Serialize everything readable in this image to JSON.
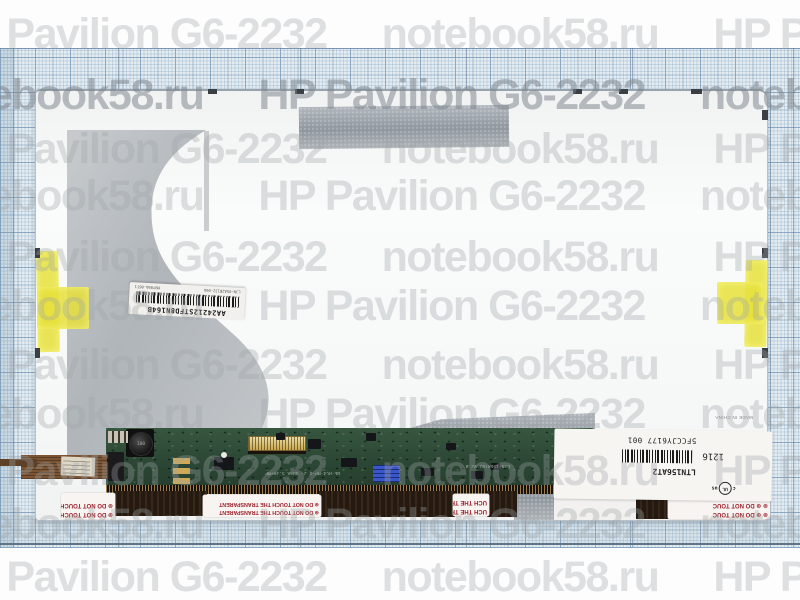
{
  "watermark": {
    "model_text": "HP Pavilion G6-2232",
    "site_text": "notebook58.ru",
    "rows": [
      {
        "y": 35,
        "offset": -60,
        "strong": false
      },
      {
        "y": 96,
        "offset": -515,
        "strong": true
      },
      {
        "y": 150,
        "offset": -60,
        "strong": false
      },
      {
        "y": 197,
        "offset": -515,
        "strong": false
      },
      {
        "y": 258,
        "offset": -60,
        "strong": false
      },
      {
        "y": 307,
        "offset": -515,
        "strong": false
      },
      {
        "y": 366,
        "offset": -60,
        "strong": false
      },
      {
        "y": 415,
        "offset": -515,
        "strong": false
      },
      {
        "y": 472,
        "offset": -60,
        "strong": false
      },
      {
        "y": 525,
        "offset": -515,
        "strong": false
      },
      {
        "y": 578,
        "offset": -60,
        "strong": false
      }
    ]
  },
  "panel": {
    "barcode_sticker": {
      "main_code": "AA24212STFD8N164B",
      "sub_left": "LJN-05A2B132-09A",
      "sub_right": "M9T09A-06T1"
    },
    "info_label": {
      "serial": "5FCCJY6177 001",
      "model": "LTN156AT2",
      "date_code": "1216",
      "cert_c": "c",
      "cert_ul": "UL",
      "cert_us": "us",
      "origin": "MADE IN CHINA"
    },
    "stickers": {
      "warning_short": "⊛ DO NOT TOUCH THE",
      "warning_long": "⊛ DO NOT TOUCH THE TRANSPARENT",
      "warning_fragment": "UCH THE TRA",
      "warning_right": "⊛ ⊛  DO NOT TOUC"
    },
    "pcb": {
      "inductor_label": "100",
      "silkscreen_1": "BE-RC4-MP-Q 2- 4BmA 5.3V+MP",
      "silkscreen_2": "LTN 156AT02 V2.B"
    }
  }
}
